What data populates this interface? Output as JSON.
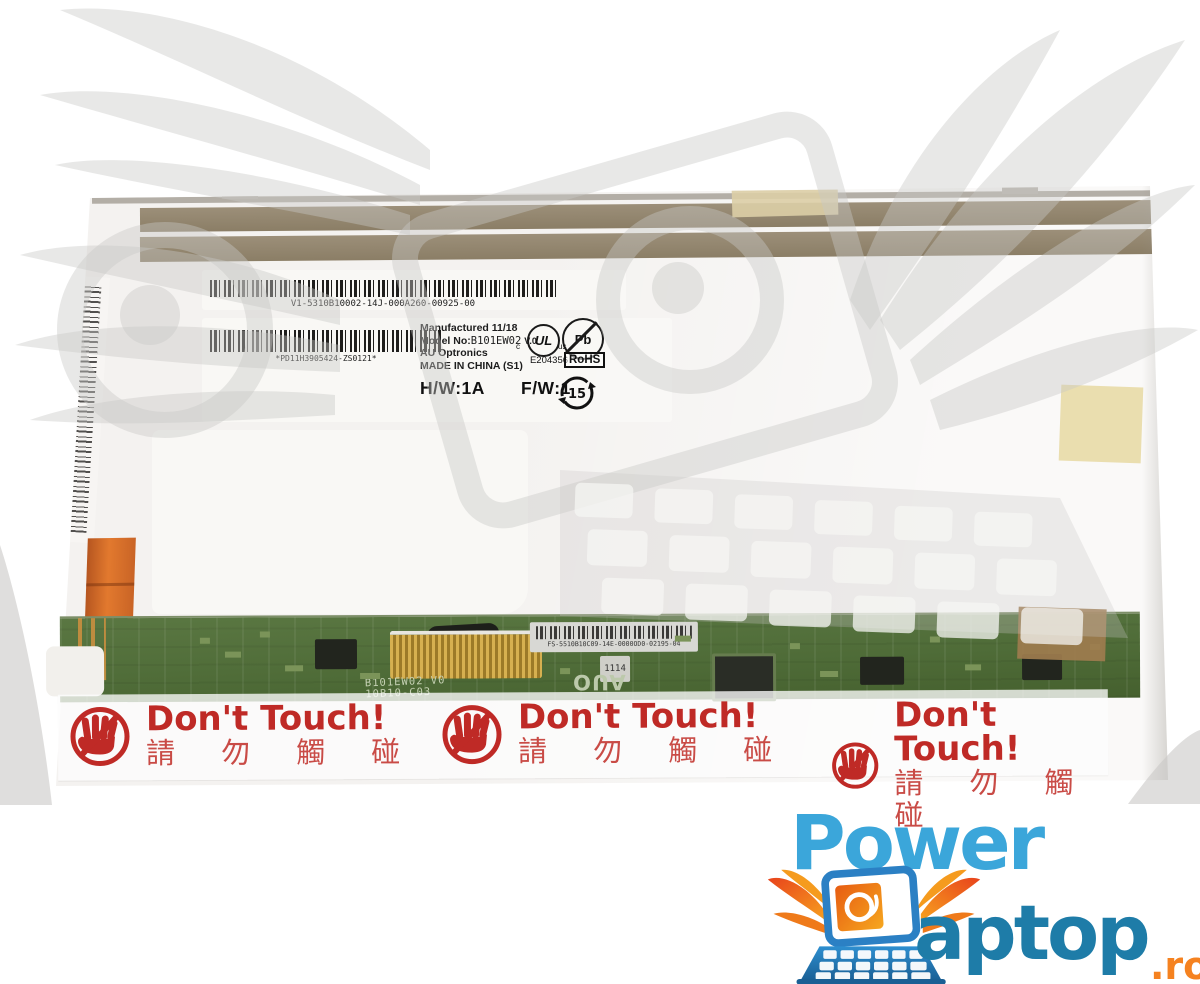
{
  "panel_label": {
    "manufactured": "Manufactured 11/18",
    "model_label": "Model No:",
    "model_value": "B101EW02",
    "model_version": "V.0",
    "brand": "AU Optronics",
    "made_in": "MADE IN CHINA (S1)",
    "hw": "H/W:1A",
    "fw": "F/W:1",
    "ul_text": "UL",
    "ul_c": "c",
    "ul_us": "us",
    "ul_number": "E204356",
    "pb_text": "Pb",
    "rohs_text": "RoHS",
    "epup_years": "15"
  },
  "barcodes": {
    "top_text": "V1-5310B10002-14J-000A260-00925-00",
    "mid_text": "*PD11H3905424-ZS0121*",
    "pcb_label_text": "FS-5510B10C09-14E-0000OD0-02195-04"
  },
  "pcb": {
    "silkscreen_model": "B101EW02 V0",
    "silkscreen_code": "10B10-C03",
    "auo_logo": "AUO",
    "date_code": "1114"
  },
  "warning_sticker": {
    "title": "Don't Touch!",
    "subtitle": "請 勿 觸 碰"
  },
  "brand_logo": {
    "word1": "Power",
    "word2": "aptop",
    "tld": ".ro"
  },
  "colors": {
    "logo_blue_light": "#3BA6DA",
    "logo_blue_dark": "#1E7CA8",
    "logo_orange": "#F58220",
    "warning_red": "#BF2A26",
    "pcb_green": "#4F6C38",
    "tape_tan": "#95876F",
    "flex_orange": "#D4692A",
    "watermark_gray": "#E3E2E0"
  }
}
